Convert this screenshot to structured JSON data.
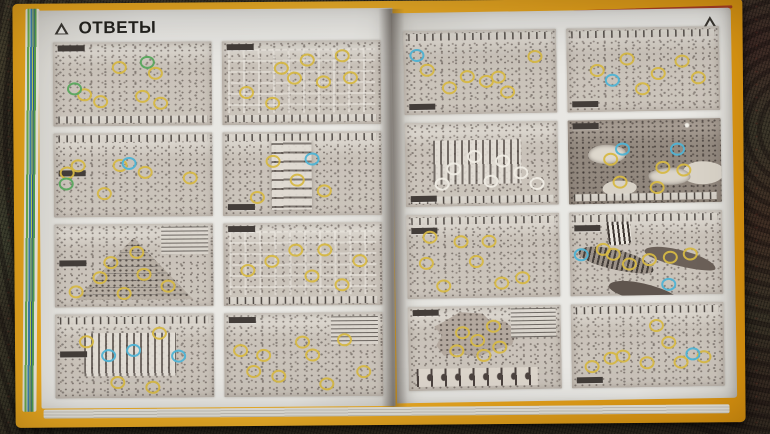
{
  "scene_type": "photograph of an open answer-key book lying on a patterned carpet",
  "carpet": {
    "base_color": "#46402f",
    "weave_color": "#2c271f",
    "right_tint": "#4a2f2a"
  },
  "book": {
    "cover_color": "#e9a41d",
    "accent_edge_color": "#a63627",
    "page_color": "#e7e6e2",
    "highlight_colors": {
      "y": "#d6b844",
      "b": "#4fb3d4",
      "g": "#5aa85e",
      "w": "#efece4"
    },
    "left_page": {
      "title": "ОТВЕТЫ",
      "corner_icon": "pyramid-triangle-icon",
      "thumbnails": [
        {
          "scene": "desert-camp",
          "tone": "light",
          "feature": "none",
          "legend": "bottom",
          "label": "pos-tl",
          "highlights": [
            {
              "x": 58,
              "y": 22,
              "c": "g"
            },
            {
              "x": 63,
              "y": 35,
              "c": "y"
            },
            {
              "x": 40,
              "y": 28,
              "c": "y"
            },
            {
              "x": 18,
              "y": 60,
              "c": "y"
            },
            {
              "x": 28,
              "y": 68,
              "c": "y"
            },
            {
              "x": 55,
              "y": 62,
              "c": "y"
            },
            {
              "x": 66,
              "y": 70,
              "c": "y"
            },
            {
              "x": 12,
              "y": 52,
              "c": "g"
            }
          ]
        },
        {
          "scene": "city-crossroads",
          "tone": "light",
          "feature": "grid",
          "legend": "bottom",
          "label": "pos-tl",
          "highlights": [
            {
              "x": 14,
              "y": 58,
              "c": "y"
            },
            {
              "x": 30,
              "y": 72,
              "c": "y"
            },
            {
              "x": 44,
              "y": 42,
              "c": "y"
            },
            {
              "x": 52,
              "y": 20,
              "c": "y"
            },
            {
              "x": 62,
              "y": 46,
              "c": "y"
            },
            {
              "x": 74,
              "y": 16,
              "c": "y"
            },
            {
              "x": 79,
              "y": 42,
              "c": "y"
            },
            {
              "x": 36,
              "y": 30,
              "c": "y"
            }
          ]
        },
        {
          "scene": "flooded-town",
          "tone": "light",
          "feature": "none",
          "legend": "top",
          "label": "pos-ml",
          "highlights": [
            {
              "x": 7,
              "y": 44,
              "c": "y"
            },
            {
              "x": 14,
              "y": 36,
              "c": "y"
            },
            {
              "x": 40,
              "y": 36,
              "c": "y"
            },
            {
              "x": 56,
              "y": 44,
              "c": "y"
            },
            {
              "x": 84,
              "y": 52,
              "c": "y"
            },
            {
              "x": 46,
              "y": 34,
              "c": "b"
            },
            {
              "x": 6,
              "y": 58,
              "c": "g"
            },
            {
              "x": 30,
              "y": 70,
              "c": "y"
            }
          ]
        },
        {
          "scene": "aqueduct-bridge",
          "tone": "light",
          "feature": "aqueduct",
          "legend": "top",
          "label": "pos-bl",
          "highlights": [
            {
              "x": 30,
              "y": 32,
              "c": "y"
            },
            {
              "x": 45,
              "y": 55,
              "c": "y"
            },
            {
              "x": 62,
              "y": 68,
              "c": "y"
            },
            {
              "x": 55,
              "y": 30,
              "c": "b"
            },
            {
              "x": 20,
              "y": 75,
              "c": "y"
            }
          ]
        },
        {
          "scene": "great-pyramid-construction",
          "tone": "light",
          "feature": "pyramid",
          "legend": "tr",
          "label": "pos-ml",
          "highlights": [
            {
              "x": 34,
              "y": 44,
              "c": "y"
            },
            {
              "x": 50,
              "y": 32,
              "c": "y"
            },
            {
              "x": 27,
              "y": 62,
              "c": "y"
            },
            {
              "x": 55,
              "y": 58,
              "c": "y"
            },
            {
              "x": 70,
              "y": 72,
              "c": "y"
            },
            {
              "x": 12,
              "y": 78,
              "c": "y"
            },
            {
              "x": 42,
              "y": 80,
              "c": "y"
            }
          ]
        },
        {
          "scene": "temple-precinct-grid",
          "tone": "light",
          "feature": "grid",
          "legend": "bottom",
          "label": "pos-tl",
          "highlights": [
            {
              "x": 14,
              "y": 54,
              "c": "y"
            },
            {
              "x": 29,
              "y": 44,
              "c": "y"
            },
            {
              "x": 44,
              "y": 30,
              "c": "y"
            },
            {
              "x": 54,
              "y": 62,
              "c": "y"
            },
            {
              "x": 73,
              "y": 72,
              "c": "y"
            },
            {
              "x": 84,
              "y": 44,
              "c": "y"
            },
            {
              "x": 62,
              "y": 30,
              "c": "y"
            }
          ]
        },
        {
          "scene": "columned-temple",
          "tone": "light",
          "feature": "colonnade",
          "legend": "top",
          "label": "pos-ml",
          "highlights": [
            {
              "x": 32,
              "y": 46,
              "c": "b"
            },
            {
              "x": 76,
              "y": 48,
              "c": "b"
            },
            {
              "x": 64,
              "y": 20,
              "c": "y"
            },
            {
              "x": 38,
              "y": 78,
              "c": "y"
            },
            {
              "x": 60,
              "y": 84,
              "c": "y"
            },
            {
              "x": 18,
              "y": 30,
              "c": "y"
            },
            {
              "x": 48,
              "y": 40,
              "c": "b"
            }
          ]
        },
        {
          "scene": "battlefield",
          "tone": "light",
          "feature": "none",
          "legend": "tr",
          "label": "pos-tl",
          "highlights": [
            {
              "x": 9,
              "y": 42,
              "c": "y"
            },
            {
              "x": 23,
              "y": 48,
              "c": "y"
            },
            {
              "x": 17,
              "y": 66,
              "c": "y"
            },
            {
              "x": 33,
              "y": 72,
              "c": "y"
            },
            {
              "x": 48,
              "y": 32,
              "c": "y"
            },
            {
              "x": 54,
              "y": 48,
              "c": "y"
            },
            {
              "x": 63,
              "y": 82,
              "c": "y"
            },
            {
              "x": 86,
              "y": 68,
              "c": "y"
            },
            {
              "x": 74,
              "y": 30,
              "c": "y"
            }
          ]
        }
      ]
    },
    "right_page": {
      "corner_icon": "pyramid-triangle-icon",
      "thumbnails": [
        {
          "scene": "harvest-fields",
          "tone": "light",
          "feature": "none",
          "legend": "top",
          "label": "pos-bl",
          "highlights": [
            {
              "x": 7,
              "y": 26,
              "c": "b"
            },
            {
              "x": 14,
              "y": 44,
              "c": "y"
            },
            {
              "x": 40,
              "y": 52,
              "c": "y"
            },
            {
              "x": 52,
              "y": 58,
              "c": "y"
            },
            {
              "x": 60,
              "y": 53,
              "c": "y"
            },
            {
              "x": 66,
              "y": 72,
              "c": "y"
            },
            {
              "x": 84,
              "y": 30,
              "c": "y"
            },
            {
              "x": 28,
              "y": 66,
              "c": "y"
            }
          ]
        },
        {
          "scene": "walled-necropolis",
          "tone": "light",
          "feature": "none",
          "legend": "top",
          "label": "pos-bl",
          "highlights": [
            {
              "x": 18,
              "y": 48,
              "c": "y"
            },
            {
              "x": 38,
              "y": 34,
              "c": "y"
            },
            {
              "x": 58,
              "y": 52,
              "c": "y"
            },
            {
              "x": 74,
              "y": 38,
              "c": "y"
            },
            {
              "x": 84,
              "y": 58,
              "c": "y"
            },
            {
              "x": 48,
              "y": 70,
              "c": "y"
            },
            {
              "x": 28,
              "y": 60,
              "c": "b"
            }
          ]
        },
        {
          "scene": "market-courtyard",
          "tone": "light",
          "feature": "colonnade",
          "legend": "bottom",
          "label": "pos-bl",
          "highlights": [
            {
              "x": 30,
              "y": 52,
              "c": "w"
            },
            {
              "x": 44,
              "y": 38,
              "c": "w"
            },
            {
              "x": 54,
              "y": 68,
              "c": "w"
            },
            {
              "x": 62,
              "y": 44,
              "c": "w"
            },
            {
              "x": 74,
              "y": 58,
              "c": "w"
            },
            {
              "x": 84,
              "y": 72,
              "c": "w"
            },
            {
              "x": 22,
              "y": 70,
              "c": "w"
            }
          ]
        },
        {
          "scene": "night-islands",
          "tone": "dark",
          "feature": "night",
          "legend": "bottom",
          "label": "pos-tl",
          "highlights": [
            {
              "x": 34,
              "y": 32,
              "c": "b"
            },
            {
              "x": 70,
              "y": 33,
              "c": "b"
            },
            {
              "x": 26,
              "y": 44,
              "c": "y"
            },
            {
              "x": 60,
              "y": 55,
              "c": "y"
            },
            {
              "x": 74,
              "y": 58,
              "c": "y"
            },
            {
              "x": 32,
              "y": 72,
              "c": "y"
            },
            {
              "x": 56,
              "y": 78,
              "c": "y"
            }
          ]
        },
        {
          "scene": "palace-corridors",
          "tone": "light",
          "feature": "none",
          "legend": "top",
          "label": "pos-tl2",
          "highlights": [
            {
              "x": 14,
              "y": 24,
              "c": "y"
            },
            {
              "x": 11,
              "y": 55,
              "c": "y"
            },
            {
              "x": 22,
              "y": 82,
              "c": "y"
            },
            {
              "x": 44,
              "y": 54,
              "c": "y"
            },
            {
              "x": 60,
              "y": 80,
              "c": "y"
            },
            {
              "x": 74,
              "y": 74,
              "c": "y"
            },
            {
              "x": 34,
              "y": 30,
              "c": "y"
            },
            {
              "x": 52,
              "y": 30,
              "c": "y"
            }
          ]
        },
        {
          "scene": "war-galleys",
          "tone": "light",
          "feature": "ships",
          "legend": "top",
          "label": "pos-tl2",
          "highlights": [
            {
              "x": 6,
              "y": 48,
              "c": "b"
            },
            {
              "x": 63,
              "y": 85,
              "c": "b"
            },
            {
              "x": 27,
              "y": 48,
              "c": "y"
            },
            {
              "x": 37,
              "y": 60,
              "c": "y"
            },
            {
              "x": 50,
              "y": 55,
              "c": "y"
            },
            {
              "x": 64,
              "y": 52,
              "c": "y"
            },
            {
              "x": 77,
              "y": 49,
              "c": "y"
            },
            {
              "x": 20,
              "y": 42,
              "c": "y"
            }
          ]
        },
        {
          "scene": "kingdom-map-with-portraits",
          "tone": "light",
          "feature": "map",
          "legend": "tr",
          "label": "pos-tl",
          "highlights": [
            {
              "x": 34,
              "y": 28,
              "c": "y"
            },
            {
              "x": 44,
              "y": 38,
              "c": "y"
            },
            {
              "x": 54,
              "y": 22,
              "c": "y"
            },
            {
              "x": 30,
              "y": 50,
              "c": "y"
            },
            {
              "x": 58,
              "y": 46,
              "c": "y"
            },
            {
              "x": 48,
              "y": 56,
              "c": "y"
            }
          ]
        },
        {
          "scene": "royal-tombs-valley",
          "tone": "light",
          "feature": "none",
          "legend": "top",
          "label": "pos-bl",
          "highlights": [
            {
              "x": 54,
              "y": 24,
              "c": "y"
            },
            {
              "x": 62,
              "y": 44,
              "c": "y"
            },
            {
              "x": 24,
              "y": 62,
              "c": "y"
            },
            {
              "x": 32,
              "y": 60,
              "c": "y"
            },
            {
              "x": 48,
              "y": 68,
              "c": "y"
            },
            {
              "x": 70,
              "y": 68,
              "c": "y"
            },
            {
              "x": 85,
              "y": 62,
              "c": "y"
            },
            {
              "x": 78,
              "y": 58,
              "c": "b"
            },
            {
              "x": 12,
              "y": 72,
              "c": "y"
            }
          ]
        }
      ]
    }
  }
}
